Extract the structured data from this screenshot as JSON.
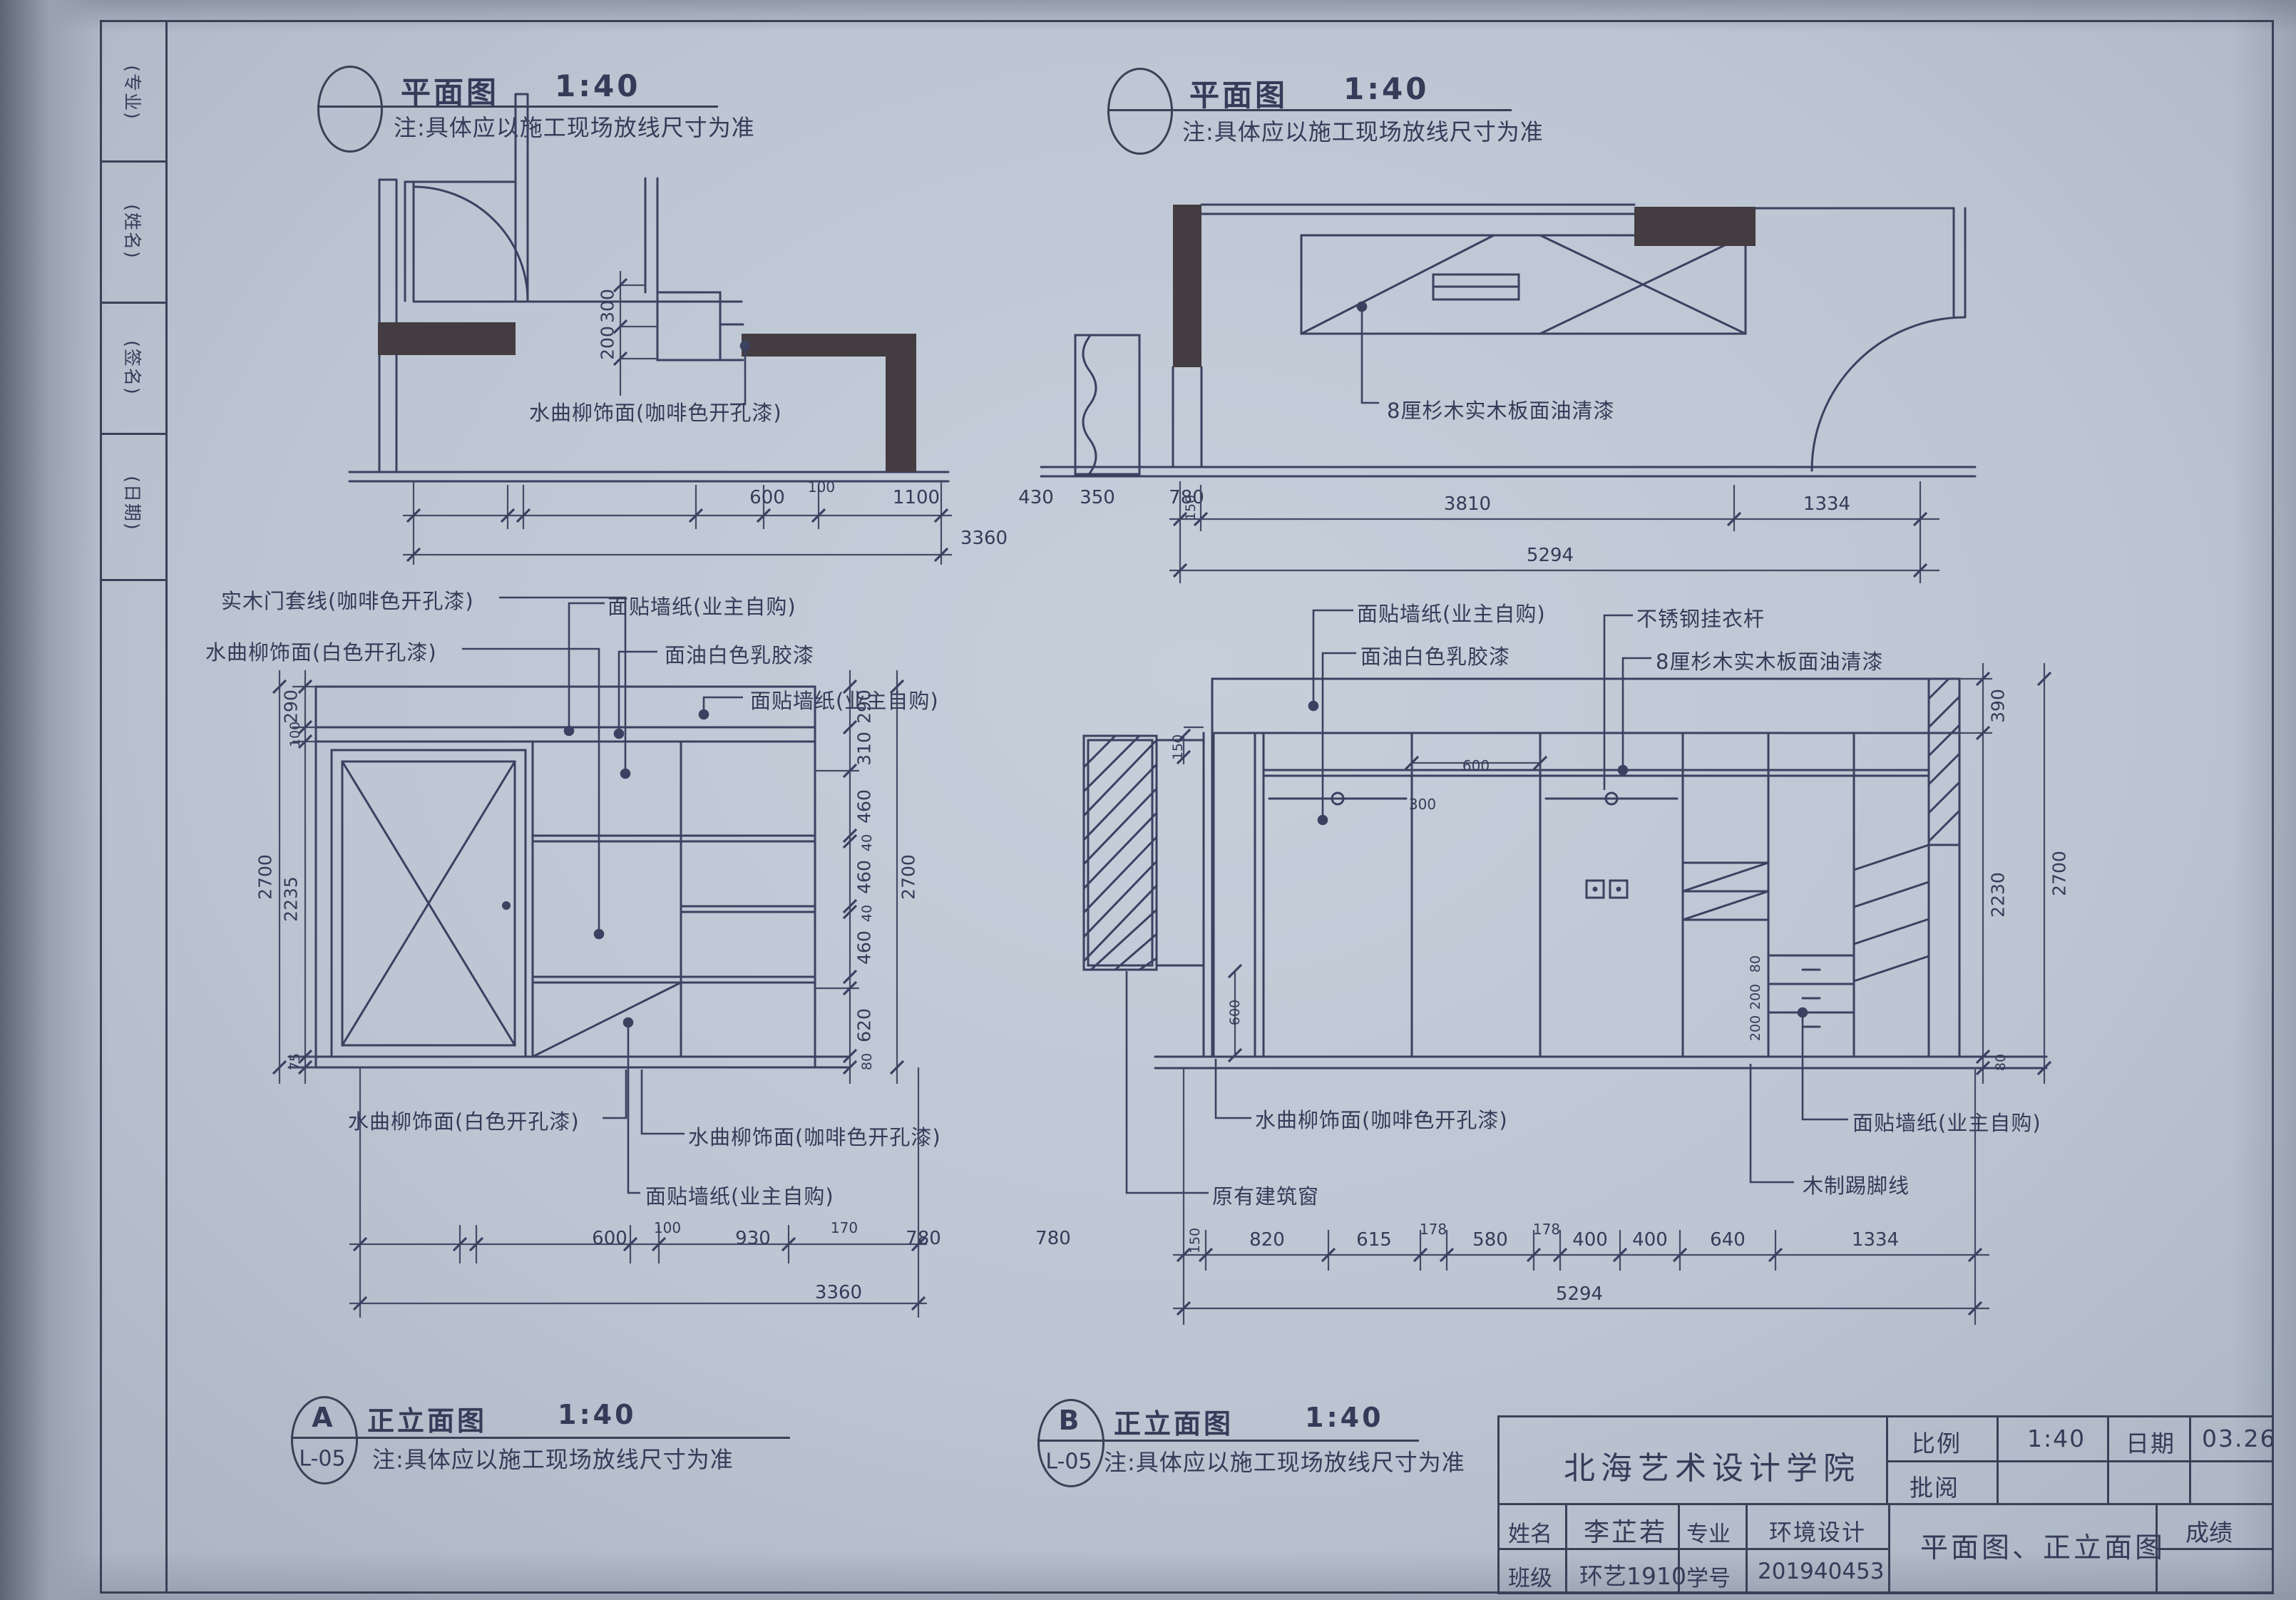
{
  "edge_strip": {
    "labels": [
      "(专业)",
      "(姓名)",
      "(签名)",
      "(日期)"
    ]
  },
  "plan_left": {
    "title": "平面图",
    "scale": "1:40",
    "note": "注:具体应以施工现场放线尺寸为准",
    "finish_label": "水曲柳饰面(咖啡色开孔漆)",
    "dims": [
      "600",
      "100",
      "1100",
      "430",
      "350",
      "780"
    ],
    "dims_total": "3360",
    "dims_side": [
      "300",
      "200"
    ]
  },
  "plan_right": {
    "title": "平面图",
    "scale": "1:40",
    "note": "注:具体应以施工现场放线尺寸为准",
    "finish_label": "8厘杉木实木板面油清漆",
    "dims": [
      "150",
      "3810",
      "1334"
    ],
    "dims_total": "5294"
  },
  "elev_a": {
    "tag": "A",
    "ref": "L-05",
    "title": "正立面图",
    "scale": "1:40",
    "note": "注:具体应以施工现场放线尺寸为准",
    "labels_top": [
      "实木门套线(咖啡色开孔漆)",
      "水曲柳饰面(白色开孔漆)",
      "面贴墙纸(业主自购)",
      "面油白色乳胶漆",
      "面贴墙纸(业主自购)"
    ],
    "labels_bottom": [
      "水曲柳饰面(白色开孔漆)",
      "水曲柳饰面(咖啡色开孔漆)",
      "面贴墙纸(业主自购)"
    ],
    "dims_bottom": [
      "600",
      "100",
      "930",
      "170",
      "780",
      "780"
    ],
    "dims_bottom_total": "3360",
    "dims_left": [
      "290",
      "100",
      "2235",
      "75"
    ],
    "dims_right": [
      "290",
      "310",
      "460",
      "40",
      "460",
      "40",
      "460",
      "620",
      "80"
    ],
    "height_total": "2700"
  },
  "elev_b": {
    "tag": "B",
    "ref": "L-05",
    "title": "正立面图",
    "scale": "1:40",
    "note": "注:具体应以施工现场放线尺寸为准",
    "labels_top": [
      "面贴墙纸(业主自购)",
      "面油白色乳胶漆",
      "不锈钢挂衣杆",
      "8厘杉木实木板面油清漆"
    ],
    "labels_bottom": [
      "水曲柳饰面(咖啡色开孔漆)",
      "原有建筑窗",
      "面贴墙纸(业主自购)",
      "木制踢脚线"
    ],
    "dims_bottom": [
      "150",
      "820",
      "615",
      "178",
      "580",
      "178",
      "400",
      "400",
      "640",
      "1334"
    ],
    "dims_bottom_total": "5294",
    "dims_right": [
      "390",
      "2230",
      "80"
    ],
    "height_total": "2700",
    "dim_window": "150",
    "dims_inner": [
      "600",
      "300",
      "80",
      "200",
      "200",
      "600"
    ]
  },
  "title_block": {
    "school": "北海艺术设计学院",
    "scale_label": "比例",
    "scale_value": "1:40",
    "date_label": "日期",
    "date_value": "03.26",
    "review_label": "批阅",
    "name_label": "姓名",
    "name_value": "李芷若",
    "major_label": "专业",
    "major_value": "环境设计",
    "class_label": "班级",
    "class_value": "环艺1910",
    "id_label": "学号",
    "id_value": "201940453",
    "drawing_title": "平面图、正立面图",
    "grade_label": "成绩"
  }
}
